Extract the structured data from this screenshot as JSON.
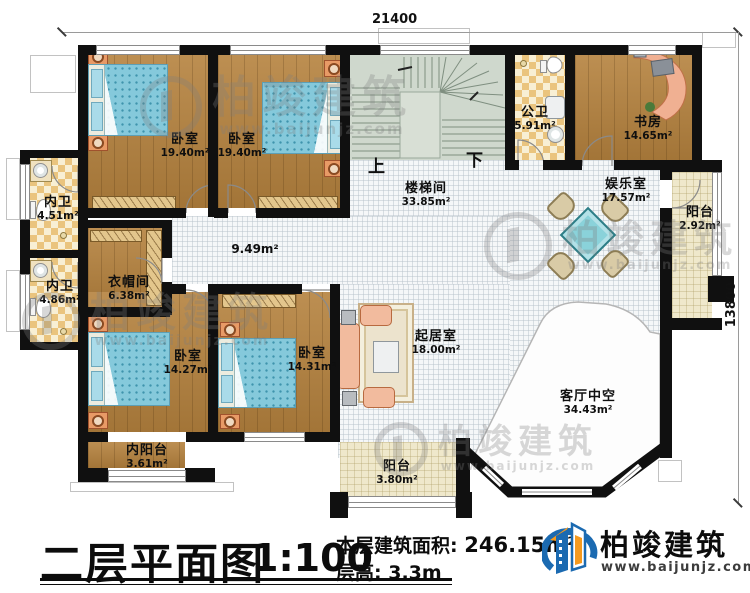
{
  "dimensions": {
    "top": "21400",
    "right": "13800"
  },
  "rooms": [
    {
      "id": "bedroom-1",
      "name": "卧室",
      "area": "19.40m²"
    },
    {
      "id": "bedroom-2",
      "name": "卧室",
      "area": "19.40m²"
    },
    {
      "id": "staircase",
      "name": "楼梯间",
      "area": "33.85m²"
    },
    {
      "id": "public-bathroom",
      "name": "公卫",
      "area": "5.91m²"
    },
    {
      "id": "study",
      "name": "书房",
      "area": "14.65m²"
    },
    {
      "id": "entertainment-room",
      "name": "娱乐室",
      "area": "17.57m²"
    },
    {
      "id": "balcony-east",
      "name": "阳台",
      "area": "2.92m²"
    },
    {
      "id": "ensuite-bathroom-1",
      "name": "内卫",
      "area": "4.51m²"
    },
    {
      "id": "ensuite-bathroom-2",
      "name": "内卫",
      "area": "4.86m²"
    },
    {
      "id": "cloakroom",
      "name": "衣帽间",
      "area": "6.38m²"
    },
    {
      "id": "corridor",
      "name": "",
      "area": "9.49m²"
    },
    {
      "id": "bedroom-3",
      "name": "卧室",
      "area": "14.27m²"
    },
    {
      "id": "bedroom-4",
      "name": "卧室",
      "area": "14.31m²"
    },
    {
      "id": "sitting-room",
      "name": "起居室",
      "area": "18.00m²"
    },
    {
      "id": "living-room-void",
      "name": "客厅中空",
      "area": "34.43m²"
    },
    {
      "id": "inner-balcony",
      "name": "内阳台",
      "area": "3.61m²"
    },
    {
      "id": "balcony-south",
      "name": "阳台",
      "area": "3.80m²"
    }
  ],
  "stairs": {
    "up_label": "上",
    "down_label": "下"
  },
  "title_block": {
    "title": "二层平面图",
    "scale": "1:100",
    "area_label": "本层建筑面积:",
    "area_value": "246.15m²",
    "floor_height_label": "层高:",
    "floor_height_value": "3.3m"
  },
  "brand": {
    "name": "柏竣建筑",
    "website": "www.baijunjz.com"
  },
  "watermark": {
    "text": "柏竣建筑",
    "website": "www.baijunjz.com"
  },
  "colors": {
    "wall": "#101010",
    "wood_floor": "#b5823e",
    "bed": "#85c9db",
    "checker_tile": "#eac47e",
    "stair_floor": "#cfd8cd",
    "balcony_floor": "#efe8cb",
    "brand_blue": "#1b6ab1",
    "brand_orange": "#f59a1f"
  }
}
